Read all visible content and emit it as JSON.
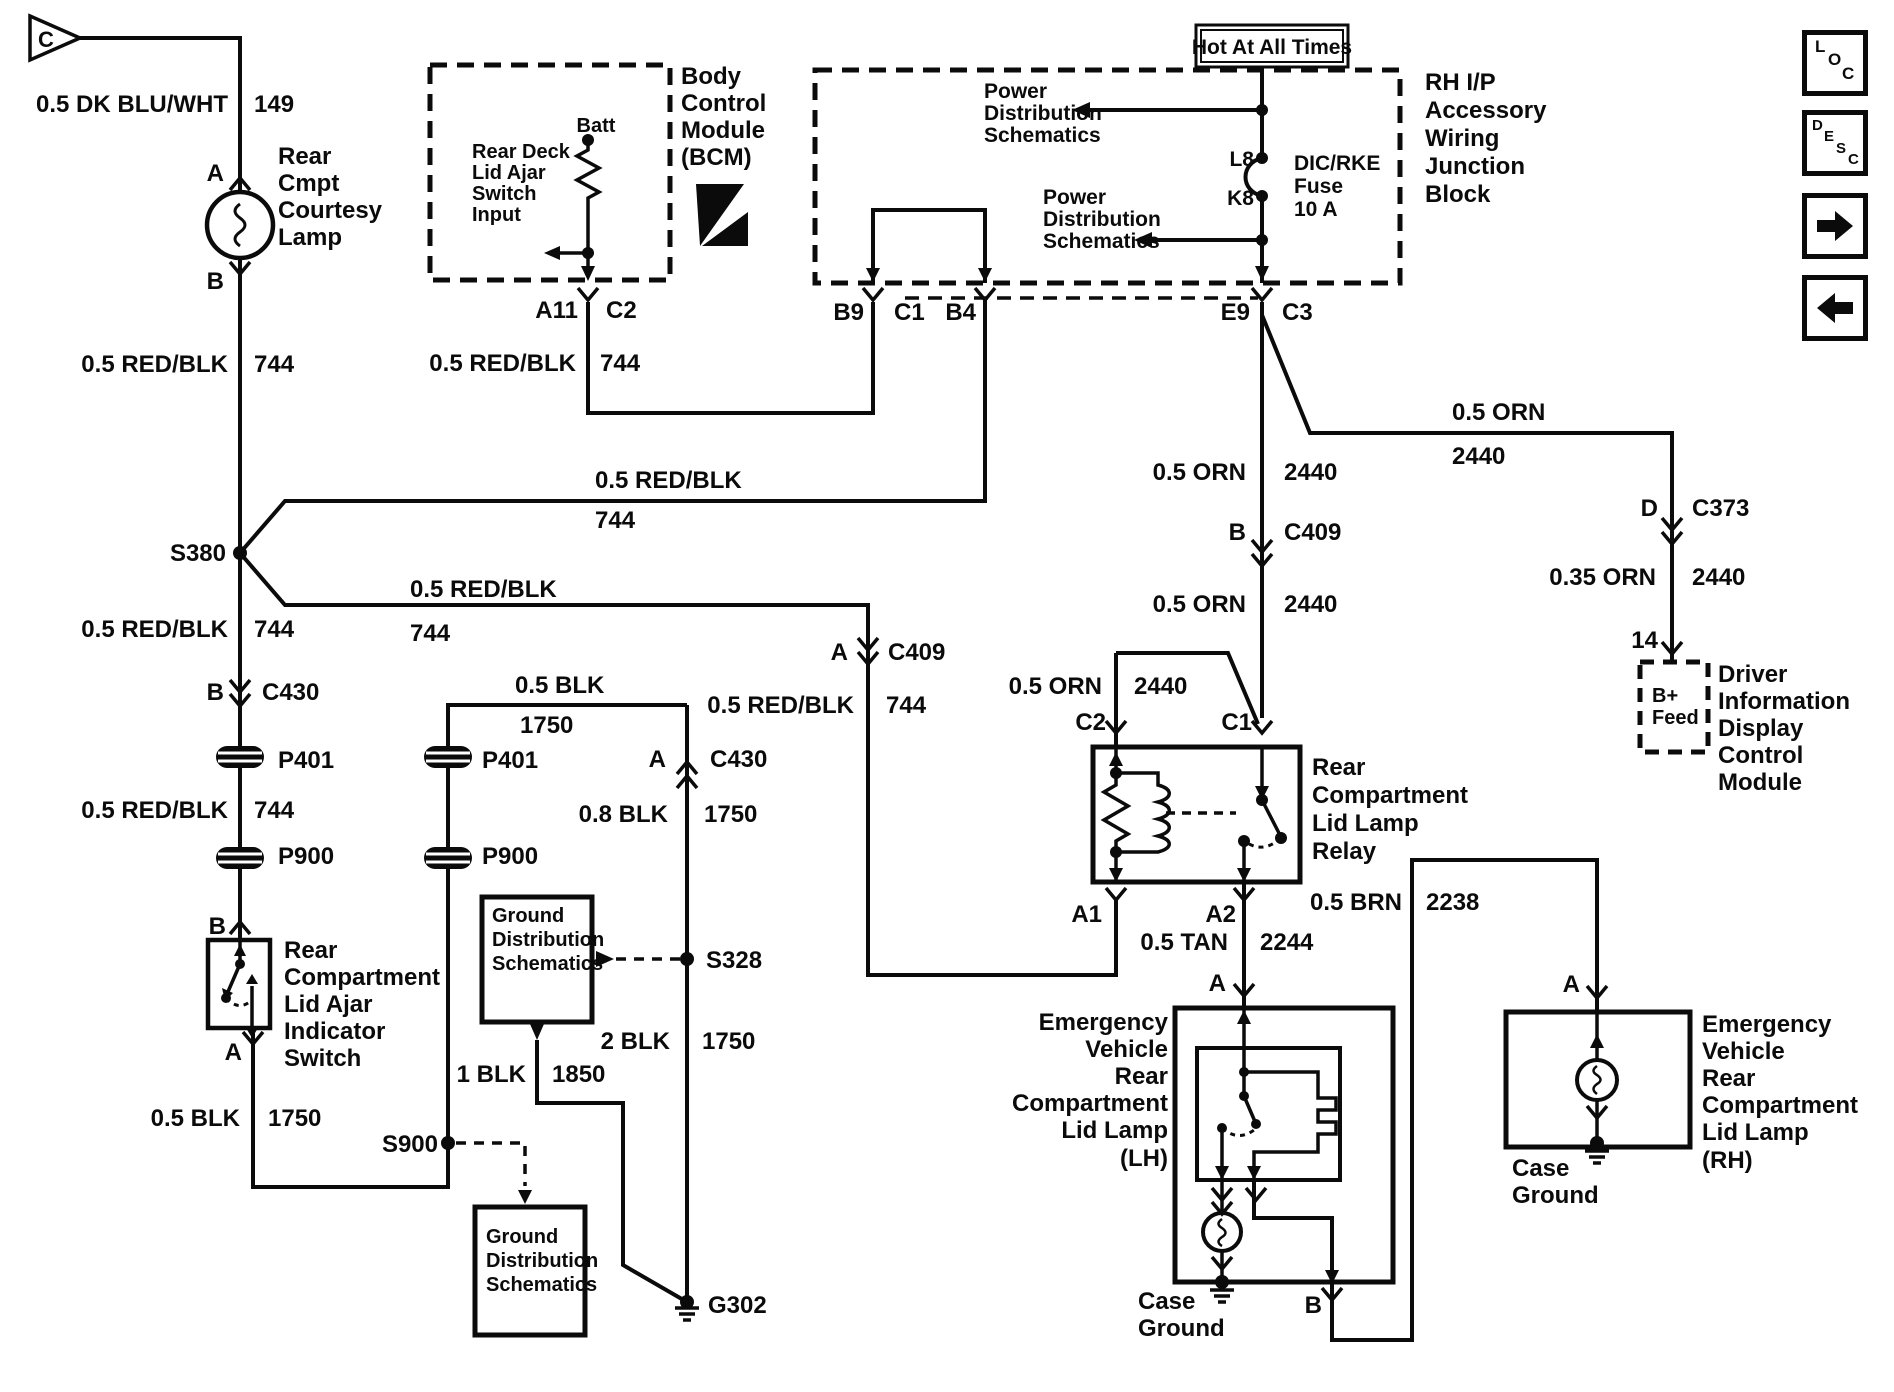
{
  "colors": {
    "ink": "#0b0b0b",
    "paper": "#ffffff"
  },
  "toolbar": {
    "loc_label": "LOC",
    "desc_label": "DESC",
    "forward_icon": "arrow-right",
    "back_icon": "arrow-left"
  },
  "diagram": {
    "power_note": "Hot At All Times",
    "components": {
      "bcm": [
        "Body",
        "Control",
        "Module",
        "(BCM)"
      ],
      "bcm_input": [
        "Rear Deck",
        "Lid Ajar",
        "Switch",
        "Input"
      ],
      "junction_block": [
        "RH I/P",
        "Accessory",
        "Wiring",
        "Junction",
        "Block"
      ],
      "fuse": [
        "DIC/RKE",
        "Fuse",
        "10 A"
      ],
      "relay": [
        "Rear",
        "Compartment",
        "Lid Lamp",
        "Relay"
      ],
      "courtesy_lamp": [
        "Rear",
        "Cmpt",
        "Courtesy",
        "Lamp"
      ],
      "ajar_switch": [
        "Rear",
        "Compartment",
        "Lid Ajar",
        "Indicator",
        "Switch"
      ],
      "lh_lamp": [
        "Emergency",
        "Vehicle",
        "Rear",
        "Compartment",
        "Lid Lamp",
        "(LH)"
      ],
      "rh_lamp": [
        "Emergency",
        "Vehicle",
        "Rear",
        "Compartment",
        "Lid Lamp",
        "(RH)"
      ],
      "didcm": [
        "Driver",
        "Information",
        "Display",
        "Control",
        "Module"
      ],
      "didcm_pin_fn": [
        "B+",
        "Feed"
      ],
      "ground_ref": [
        "Ground",
        "Distribution",
        "Schematics"
      ],
      "power_ref": [
        "Power",
        "Distribution",
        "Schematics"
      ]
    },
    "labels": [
      {
        "n": "connector-c-label",
        "t": "C",
        "x": 46,
        "y": 47,
        "a": "middle",
        "s": 22
      },
      {
        "n": "wire-label",
        "t": "0.5 DK BLU/WHT",
        "x": 228,
        "y": 112,
        "a": "end"
      },
      {
        "n": "wire-label",
        "t": "149",
        "x": 254,
        "y": 112
      },
      {
        "n": "pin-label",
        "t": "A",
        "x": 224,
        "y": 181,
        "a": "end"
      },
      {
        "n": "component-label",
        "t": "Rear",
        "x": 278,
        "y": 164
      },
      {
        "n": "component-label",
        "t": "Cmpt",
        "x": 278,
        "y": 191
      },
      {
        "n": "component-label",
        "t": "Courtesy",
        "x": 278,
        "y": 218
      },
      {
        "n": "component-label",
        "t": "Lamp",
        "x": 278,
        "y": 245
      },
      {
        "n": "pin-label",
        "t": "B",
        "x": 224,
        "y": 289,
        "a": "end"
      },
      {
        "n": "wire-label",
        "t": "0.5 RED/BLK",
        "x": 228,
        "y": 372,
        "a": "end"
      },
      {
        "n": "wire-label",
        "t": "744",
        "x": 254,
        "y": 372
      },
      {
        "n": "splice-label",
        "t": "S380",
        "x": 226,
        "y": 561,
        "a": "end"
      },
      {
        "n": "wire-label",
        "t": "0.5 RED/BLK",
        "x": 595,
        "y": 488
      },
      {
        "n": "wire-label",
        "t": "744",
        "x": 595,
        "y": 528
      },
      {
        "n": "wire-label",
        "t": "0.5 RED/BLK",
        "x": 410,
        "y": 597
      },
      {
        "n": "wire-label",
        "t": "744",
        "x": 410,
        "y": 641
      },
      {
        "n": "wire-label",
        "t": "0.5 RED/BLK",
        "x": 228,
        "y": 637,
        "a": "end"
      },
      {
        "n": "wire-label",
        "t": "744",
        "x": 254,
        "y": 637
      },
      {
        "n": "pin-label",
        "t": "B",
        "x": 224,
        "y": 700,
        "a": "end"
      },
      {
        "n": "connector-label",
        "t": "C430",
        "x": 262,
        "y": 700
      },
      {
        "n": "connector-label",
        "t": "P401",
        "x": 278,
        "y": 768
      },
      {
        "n": "wire-label",
        "t": "0.5 RED/BLK",
        "x": 228,
        "y": 818,
        "a": "end"
      },
      {
        "n": "wire-label",
        "t": "744",
        "x": 254,
        "y": 818
      },
      {
        "n": "connector-label",
        "t": "P900",
        "x": 278,
        "y": 864
      },
      {
        "n": "pin-label",
        "t": "B",
        "x": 226,
        "y": 934,
        "a": "end"
      },
      {
        "n": "component-label",
        "t": "Rear",
        "x": 284,
        "y": 958
      },
      {
        "n": "component-label",
        "t": "Compartment",
        "x": 284,
        "y": 985
      },
      {
        "n": "component-label",
        "t": "Lid Ajar",
        "x": 284,
        "y": 1012
      },
      {
        "n": "component-label",
        "t": "Indicator",
        "x": 284,
        "y": 1039
      },
      {
        "n": "component-label",
        "t": "Switch",
        "x": 284,
        "y": 1066
      },
      {
        "n": "pin-label",
        "t": "A",
        "x": 242,
        "y": 1060,
        "a": "end"
      },
      {
        "n": "wire-label",
        "t": "0.5 BLK",
        "x": 240,
        "y": 1126,
        "a": "end"
      },
      {
        "n": "wire-label",
        "t": "1750",
        "x": 268,
        "y": 1126
      },
      {
        "n": "splice-label",
        "t": "S900",
        "x": 438,
        "y": 1152,
        "a": "end"
      },
      {
        "n": "wire-label",
        "t": "0.5 BLK",
        "x": 515,
        "y": 693
      },
      {
        "n": "wire-label",
        "t": "1750",
        "x": 520,
        "y": 733
      },
      {
        "n": "connector-label",
        "t": "P401",
        "x": 482,
        "y": 768
      },
      {
        "n": "connector-label",
        "t": "P900",
        "x": 482,
        "y": 864
      },
      {
        "n": "pin-label",
        "t": "A",
        "x": 666,
        "y": 767,
        "a": "end"
      },
      {
        "n": "connector-label",
        "t": "C430",
        "x": 710,
        "y": 767
      },
      {
        "n": "wire-label",
        "t": "0.8 BLK",
        "x": 668,
        "y": 822,
        "a": "end"
      },
      {
        "n": "wire-label",
        "t": "1750",
        "x": 704,
        "y": 822
      },
      {
        "n": "splice-label",
        "t": "S328",
        "x": 706,
        "y": 968
      },
      {
        "n": "wire-label",
        "t": "2 BLK",
        "x": 670,
        "y": 1049,
        "a": "end"
      },
      {
        "n": "wire-label",
        "t": "1750",
        "x": 702,
        "y": 1049
      },
      {
        "n": "ground-label",
        "t": "G302",
        "x": 708,
        "y": 1313
      },
      {
        "n": "reference-label",
        "t": "Ground",
        "x": 492,
        "y": 922,
        "s": 20
      },
      {
        "n": "reference-label",
        "t": "Distribution",
        "x": 492,
        "y": 946,
        "s": 20
      },
      {
        "n": "reference-label",
        "t": "Schematics",
        "x": 492,
        "y": 970,
        "s": 20
      },
      {
        "n": "wire-label",
        "t": "1 BLK",
        "x": 526,
        "y": 1082,
        "a": "end"
      },
      {
        "n": "wire-label",
        "t": "1850",
        "x": 552,
        "y": 1082
      },
      {
        "n": "reference-label",
        "t": "Ground",
        "x": 486,
        "y": 1243,
        "s": 20
      },
      {
        "n": "reference-label",
        "t": "Distribution",
        "x": 486,
        "y": 1267,
        "s": 20
      },
      {
        "n": "reference-label",
        "t": "Schematics",
        "x": 486,
        "y": 1291,
        "s": 20
      },
      {
        "n": "component-label",
        "t": "Rear Deck",
        "x": 472,
        "y": 158,
        "s": 20
      },
      {
        "n": "component-label",
        "t": "Lid Ajar",
        "x": 472,
        "y": 179,
        "s": 20
      },
      {
        "n": "component-label",
        "t": "Switch",
        "x": 472,
        "y": 200,
        "s": 20
      },
      {
        "n": "component-label",
        "t": "Input",
        "x": 472,
        "y": 221,
        "s": 20
      },
      {
        "n": "pin-label",
        "t": "Batt",
        "x": 596,
        "y": 132,
        "a": "middle",
        "s": 20
      },
      {
        "n": "pin-label",
        "t": "A11",
        "x": 578,
        "y": 318,
        "a": "end"
      },
      {
        "n": "connector-label",
        "t": "C2",
        "x": 606,
        "y": 318
      },
      {
        "n": "wire-label",
        "t": "0.5 RED/BLK",
        "x": 576,
        "y": 371,
        "a": "end"
      },
      {
        "n": "wire-label",
        "t": "744",
        "x": 600,
        "y": 371
      },
      {
        "n": "component-label",
        "t": "Body",
        "x": 681,
        "y": 84
      },
      {
        "n": "component-label",
        "t": "Control",
        "x": 681,
        "y": 111
      },
      {
        "n": "component-label",
        "t": "Module",
        "x": 681,
        "y": 138
      },
      {
        "n": "component-label",
        "t": "(BCM)",
        "x": 681,
        "y": 165
      },
      {
        "n": "pin-label",
        "t": "B9",
        "x": 864,
        "y": 320,
        "a": "end"
      },
      {
        "n": "connector-label",
        "t": "C1",
        "x": 894,
        "y": 320
      },
      {
        "n": "pin-label",
        "t": "B4",
        "x": 976,
        "y": 320,
        "a": "end"
      },
      {
        "n": "reference-label",
        "t": "Power",
        "x": 984,
        "y": 98,
        "s": 21
      },
      {
        "n": "reference-label",
        "t": "Distribution",
        "x": 984,
        "y": 120,
        "s": 21
      },
      {
        "n": "reference-label",
        "t": "Schematics",
        "x": 984,
        "y": 142,
        "s": 21
      },
      {
        "n": "reference-label",
        "t": "Power",
        "x": 1043,
        "y": 204,
        "s": 21
      },
      {
        "n": "reference-label",
        "t": "Distribution",
        "x": 1043,
        "y": 226,
        "s": 21
      },
      {
        "n": "reference-label",
        "t": "Schematics",
        "x": 1043,
        "y": 248,
        "s": 21
      },
      {
        "n": "pin-label",
        "t": "L8",
        "x": 1254,
        "y": 166,
        "a": "end",
        "s": 21
      },
      {
        "n": "pin-label",
        "t": "K8",
        "x": 1254,
        "y": 205,
        "a": "end",
        "s": 21
      },
      {
        "n": "fuse-label",
        "t": "DIC/RKE",
        "x": 1294,
        "y": 170,
        "s": 21
      },
      {
        "n": "fuse-label",
        "t": "Fuse",
        "x": 1294,
        "y": 193,
        "s": 21
      },
      {
        "n": "fuse-label",
        "t": "10 A",
        "x": 1294,
        "y": 216,
        "s": 21
      },
      {
        "n": "power-note",
        "t": "Hot At All Times",
        "x": 1272,
        "y": 54,
        "a": "middle",
        "s": 21
      },
      {
        "n": "component-label",
        "t": "RH I/P",
        "x": 1425,
        "y": 90
      },
      {
        "n": "component-label",
        "t": "Accessory",
        "x": 1425,
        "y": 118
      },
      {
        "n": "component-label",
        "t": "Wiring",
        "x": 1425,
        "y": 146
      },
      {
        "n": "component-label",
        "t": "Junction",
        "x": 1425,
        "y": 174
      },
      {
        "n": "component-label",
        "t": "Block",
        "x": 1425,
        "y": 202
      },
      {
        "n": "pin-label",
        "t": "E9",
        "x": 1250,
        "y": 320,
        "a": "end"
      },
      {
        "n": "connector-label",
        "t": "C3",
        "x": 1282,
        "y": 320
      },
      {
        "n": "wire-label",
        "t": "0.5 ORN",
        "x": 1246,
        "y": 480,
        "a": "end"
      },
      {
        "n": "wire-label",
        "t": "2440",
        "x": 1284,
        "y": 480
      },
      {
        "n": "pin-label",
        "t": "B",
        "x": 1246,
        "y": 540,
        "a": "end"
      },
      {
        "n": "connector-label",
        "t": "C409",
        "x": 1284,
        "y": 540
      },
      {
        "n": "wire-label",
        "t": "0.5 ORN",
        "x": 1246,
        "y": 612,
        "a": "end"
      },
      {
        "n": "wire-label",
        "t": "2440",
        "x": 1284,
        "y": 612
      },
      {
        "n": "pin-label",
        "t": "A",
        "x": 848,
        "y": 660,
        "a": "end"
      },
      {
        "n": "connector-label",
        "t": "C409",
        "x": 888,
        "y": 660
      },
      {
        "n": "wire-label",
        "t": "0.5 RED/BLK",
        "x": 854,
        "y": 713,
        "a": "end"
      },
      {
        "n": "wire-label",
        "t": "744",
        "x": 886,
        "y": 713
      },
      {
        "n": "wire-label",
        "t": "0.5 ORN",
        "x": 1102,
        "y": 694,
        "a": "end"
      },
      {
        "n": "wire-label",
        "t": "2440",
        "x": 1134,
        "y": 694
      },
      {
        "n": "pin-label",
        "t": "C2",
        "x": 1106,
        "y": 730,
        "a": "end"
      },
      {
        "n": "pin-label",
        "t": "C1",
        "x": 1252,
        "y": 730,
        "a": "end"
      },
      {
        "n": "component-label",
        "t": "Rear",
        "x": 1312,
        "y": 775
      },
      {
        "n": "component-label",
        "t": "Compartment",
        "x": 1312,
        "y": 803
      },
      {
        "n": "component-label",
        "t": "Lid Lamp",
        "x": 1312,
        "y": 831
      },
      {
        "n": "component-label",
        "t": "Relay",
        "x": 1312,
        "y": 859
      },
      {
        "n": "pin-label",
        "t": "A1",
        "x": 1102,
        "y": 922,
        "a": "end"
      },
      {
        "n": "pin-label",
        "t": "A2",
        "x": 1236,
        "y": 922,
        "a": "end"
      },
      {
        "n": "wire-label",
        "t": "0.5 TAN",
        "x": 1228,
        "y": 950,
        "a": "end"
      },
      {
        "n": "wire-label",
        "t": "2244",
        "x": 1260,
        "y": 950
      },
      {
        "n": "pin-label",
        "t": "A",
        "x": 1226,
        "y": 991,
        "a": "end"
      },
      {
        "n": "component-label",
        "t": "Emergency",
        "x": 1168,
        "y": 1030,
        "a": "end"
      },
      {
        "n": "component-label",
        "t": "Vehicle",
        "x": 1168,
        "y": 1057,
        "a": "end"
      },
      {
        "n": "component-label",
        "t": "Rear",
        "x": 1168,
        "y": 1084,
        "a": "end"
      },
      {
        "n": "component-label",
        "t": "Compartment",
        "x": 1168,
        "y": 1111,
        "a": "end"
      },
      {
        "n": "component-label",
        "t": "Lid Lamp",
        "x": 1168,
        "y": 1138,
        "a": "end"
      },
      {
        "n": "component-label",
        "t": "(LH)",
        "x": 1168,
        "y": 1166,
        "a": "end"
      },
      {
        "n": "ground-label",
        "t": "Case",
        "x": 1138,
        "y": 1309
      },
      {
        "n": "ground-label",
        "t": "Ground",
        "x": 1138,
        "y": 1336
      },
      {
        "n": "pin-label",
        "t": "B",
        "x": 1322,
        "y": 1313,
        "a": "end"
      },
      {
        "n": "wire-label",
        "t": "0.5 BRN",
        "x": 1402,
        "y": 910,
        "a": "end"
      },
      {
        "n": "wire-label",
        "t": "2238",
        "x": 1426,
        "y": 910
      },
      {
        "n": "wire-label",
        "t": "0.5 ORN",
        "x": 1452,
        "y": 420
      },
      {
        "n": "wire-label",
        "t": "2440",
        "x": 1452,
        "y": 464
      },
      {
        "n": "pin-label",
        "t": "D",
        "x": 1658,
        "y": 516,
        "a": "end"
      },
      {
        "n": "connector-label",
        "t": "C373",
        "x": 1692,
        "y": 516
      },
      {
        "n": "wire-label",
        "t": "0.35 ORN",
        "x": 1656,
        "y": 585,
        "a": "end"
      },
      {
        "n": "wire-label",
        "t": "2440",
        "x": 1692,
        "y": 585
      },
      {
        "n": "pin-label",
        "t": "14",
        "x": 1658,
        "y": 648,
        "a": "end"
      },
      {
        "n": "pin-function-label",
        "t": "B+",
        "x": 1652,
        "y": 702,
        "s": 20
      },
      {
        "n": "pin-function-label",
        "t": "Feed",
        "x": 1652,
        "y": 724,
        "s": 20
      },
      {
        "n": "component-label",
        "t": "Driver",
        "x": 1718,
        "y": 682
      },
      {
        "n": "component-label",
        "t": "Information",
        "x": 1718,
        "y": 709
      },
      {
        "n": "component-label",
        "t": "Display",
        "x": 1718,
        "y": 736
      },
      {
        "n": "component-label",
        "t": "Control",
        "x": 1718,
        "y": 763
      },
      {
        "n": "component-label",
        "t": "Module",
        "x": 1718,
        "y": 790
      },
      {
        "n": "pin-label",
        "t": "A",
        "x": 1580,
        "y": 992,
        "a": "end"
      },
      {
        "n": "component-label",
        "t": "Emergency",
        "x": 1702,
        "y": 1032
      },
      {
        "n": "component-label",
        "t": "Vehicle",
        "x": 1702,
        "y": 1059
      },
      {
        "n": "component-label",
        "t": "Rear",
        "x": 1702,
        "y": 1086
      },
      {
        "n": "component-label",
        "t": "Compartment",
        "x": 1702,
        "y": 1113
      },
      {
        "n": "component-label",
        "t": "Lid Lamp",
        "x": 1702,
        "y": 1140
      },
      {
        "n": "component-label",
        "t": "(RH)",
        "x": 1702,
        "y": 1168
      },
      {
        "n": "ground-label",
        "t": "Case",
        "x": 1512,
        "y": 1176
      },
      {
        "n": "ground-label",
        "t": "Ground",
        "x": 1512,
        "y": 1203
      }
    ]
  }
}
